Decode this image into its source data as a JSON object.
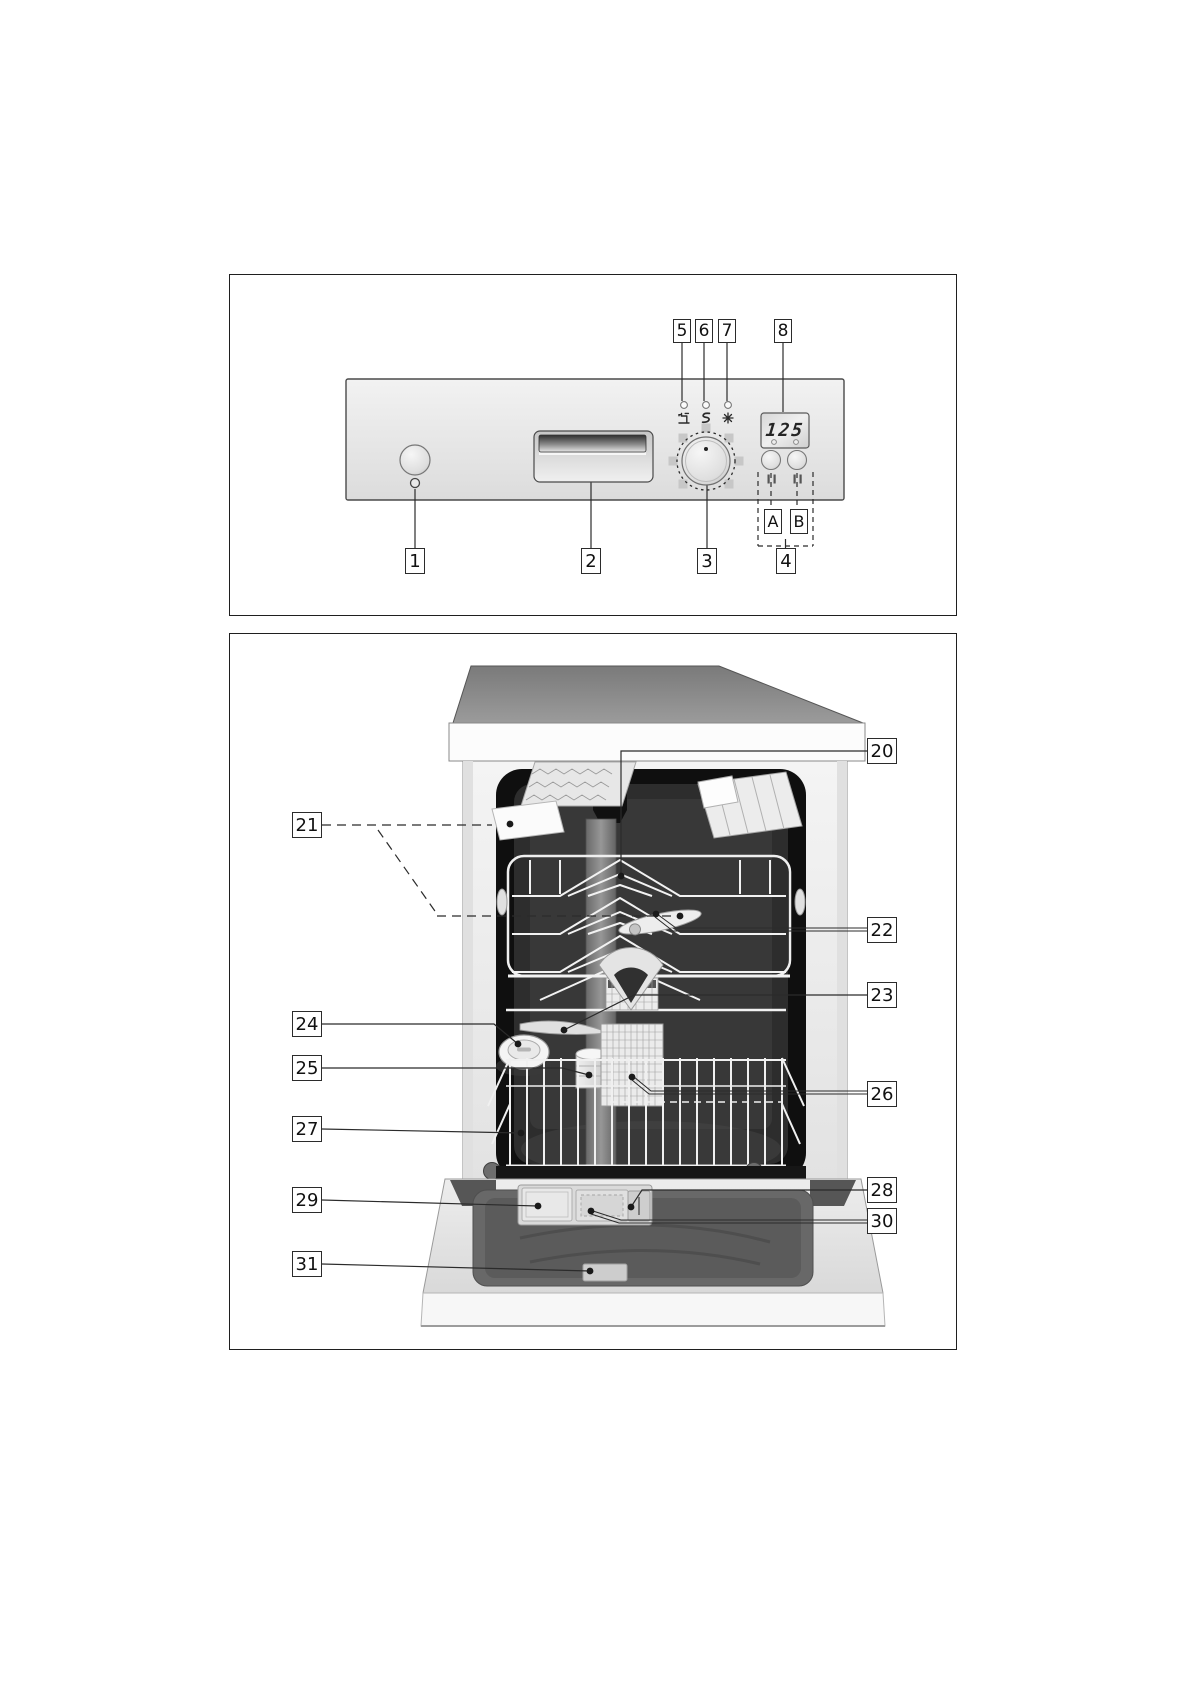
{
  "page": {
    "type": "appliance-manual-diagram-page",
    "background": "#ffffff",
    "line_color": "#2b2b2b",
    "panel_color": "#e9e9e9",
    "interior_color": "#2d2d2d"
  },
  "figure1": {
    "name": "control-panel-diagram",
    "top_callouts": [
      "5",
      "6",
      "7",
      "8"
    ],
    "bottom_callouts": [
      "1",
      "2",
      "3",
      "4"
    ],
    "option_buttons": [
      "A",
      "B"
    ],
    "display": {
      "value": "125"
    },
    "icons": [
      {
        "name": "power-icon"
      },
      {
        "name": "water-tap-icon"
      },
      {
        "name": "salt-refill-icon"
      },
      {
        "name": "rinse-aid-icon"
      }
    ]
  },
  "figure2": {
    "name": "dishwasher-interior-diagram",
    "left_callouts": [
      "21",
      "24",
      "25",
      "27",
      "29",
      "31"
    ],
    "right_callouts": [
      "20",
      "22",
      "23",
      "26",
      "28",
      "30"
    ]
  }
}
